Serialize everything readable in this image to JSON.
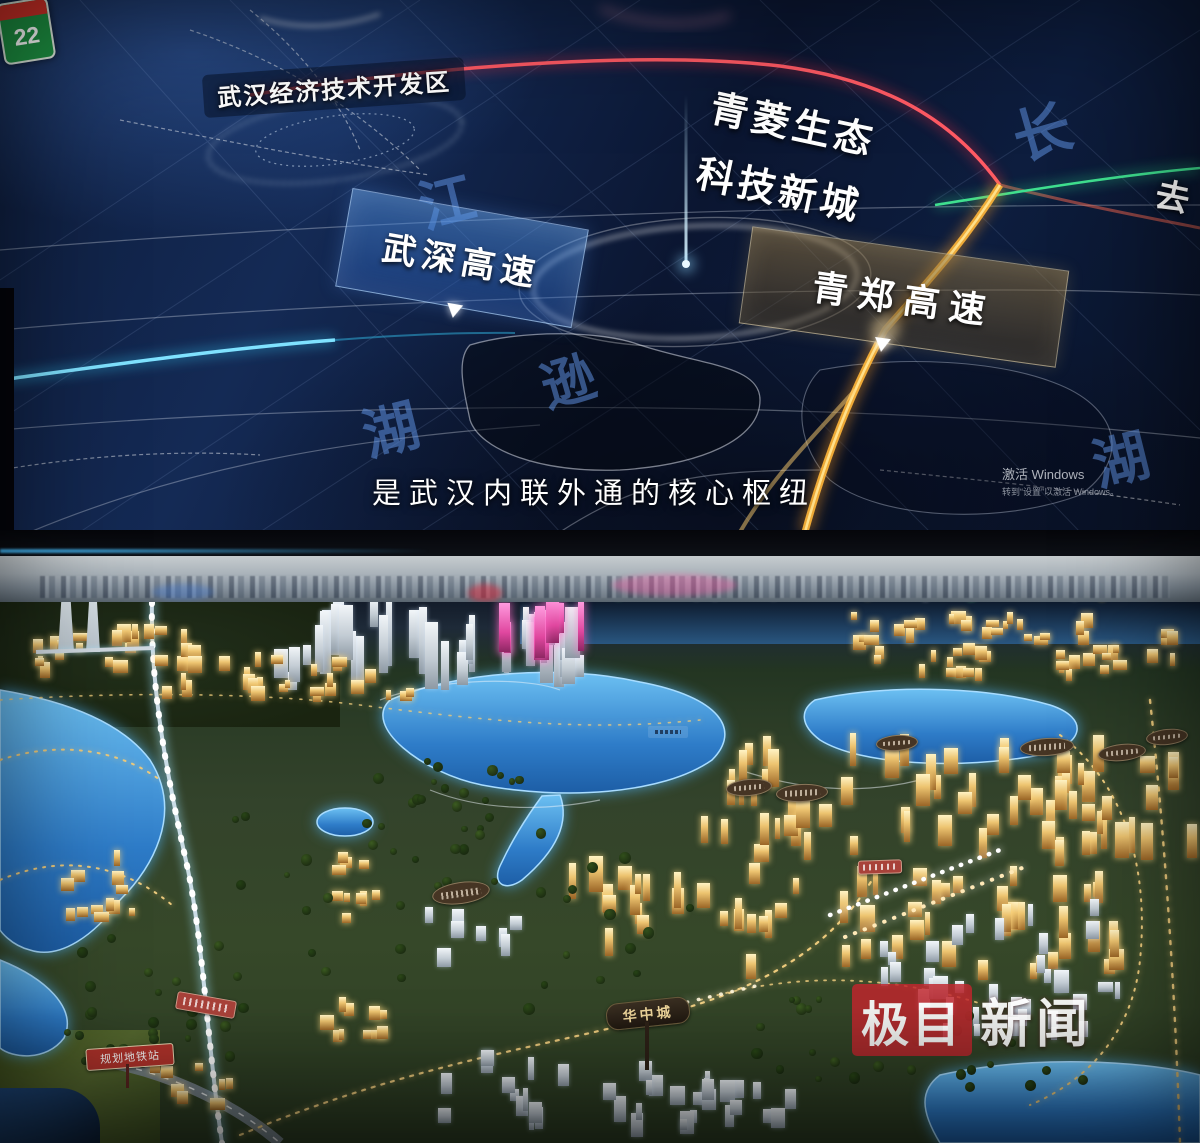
{
  "screen": {
    "dev_zone_label": "武汉经济技术开发区",
    "new_city_line1": "青菱生态",
    "new_city_line2": "科技新城",
    "banner_left": "武深高速",
    "banner_right": "青郑高速",
    "caption": "是武汉内联外通的核心枢纽",
    "edge_text": "去",
    "shield_number": "22",
    "activation_line1": "激活 Windows",
    "activation_line2": "转到“设置”以激活 Windows。",
    "map_char_1": "长",
    "map_char_2": "江",
    "map_char_3": "逊",
    "map_char_4": "湖",
    "map_char_5": "湖"
  },
  "model": {
    "sign_huazhong": "华中城",
    "sign_metro": "规划地铁站"
  },
  "watermark": {
    "box_text": "极目",
    "plain_text": "新闻"
  },
  "colors": {
    "water_blue": "#2f86d8",
    "building_gold": "#f0c878",
    "screen_navy": "#0c1a36",
    "watermark_red": "#c1272d",
    "route_orange": "#ffb638",
    "route_red": "#ff5a64",
    "route_green": "#3fe08f",
    "route_cyan": "#35c8f5"
  }
}
